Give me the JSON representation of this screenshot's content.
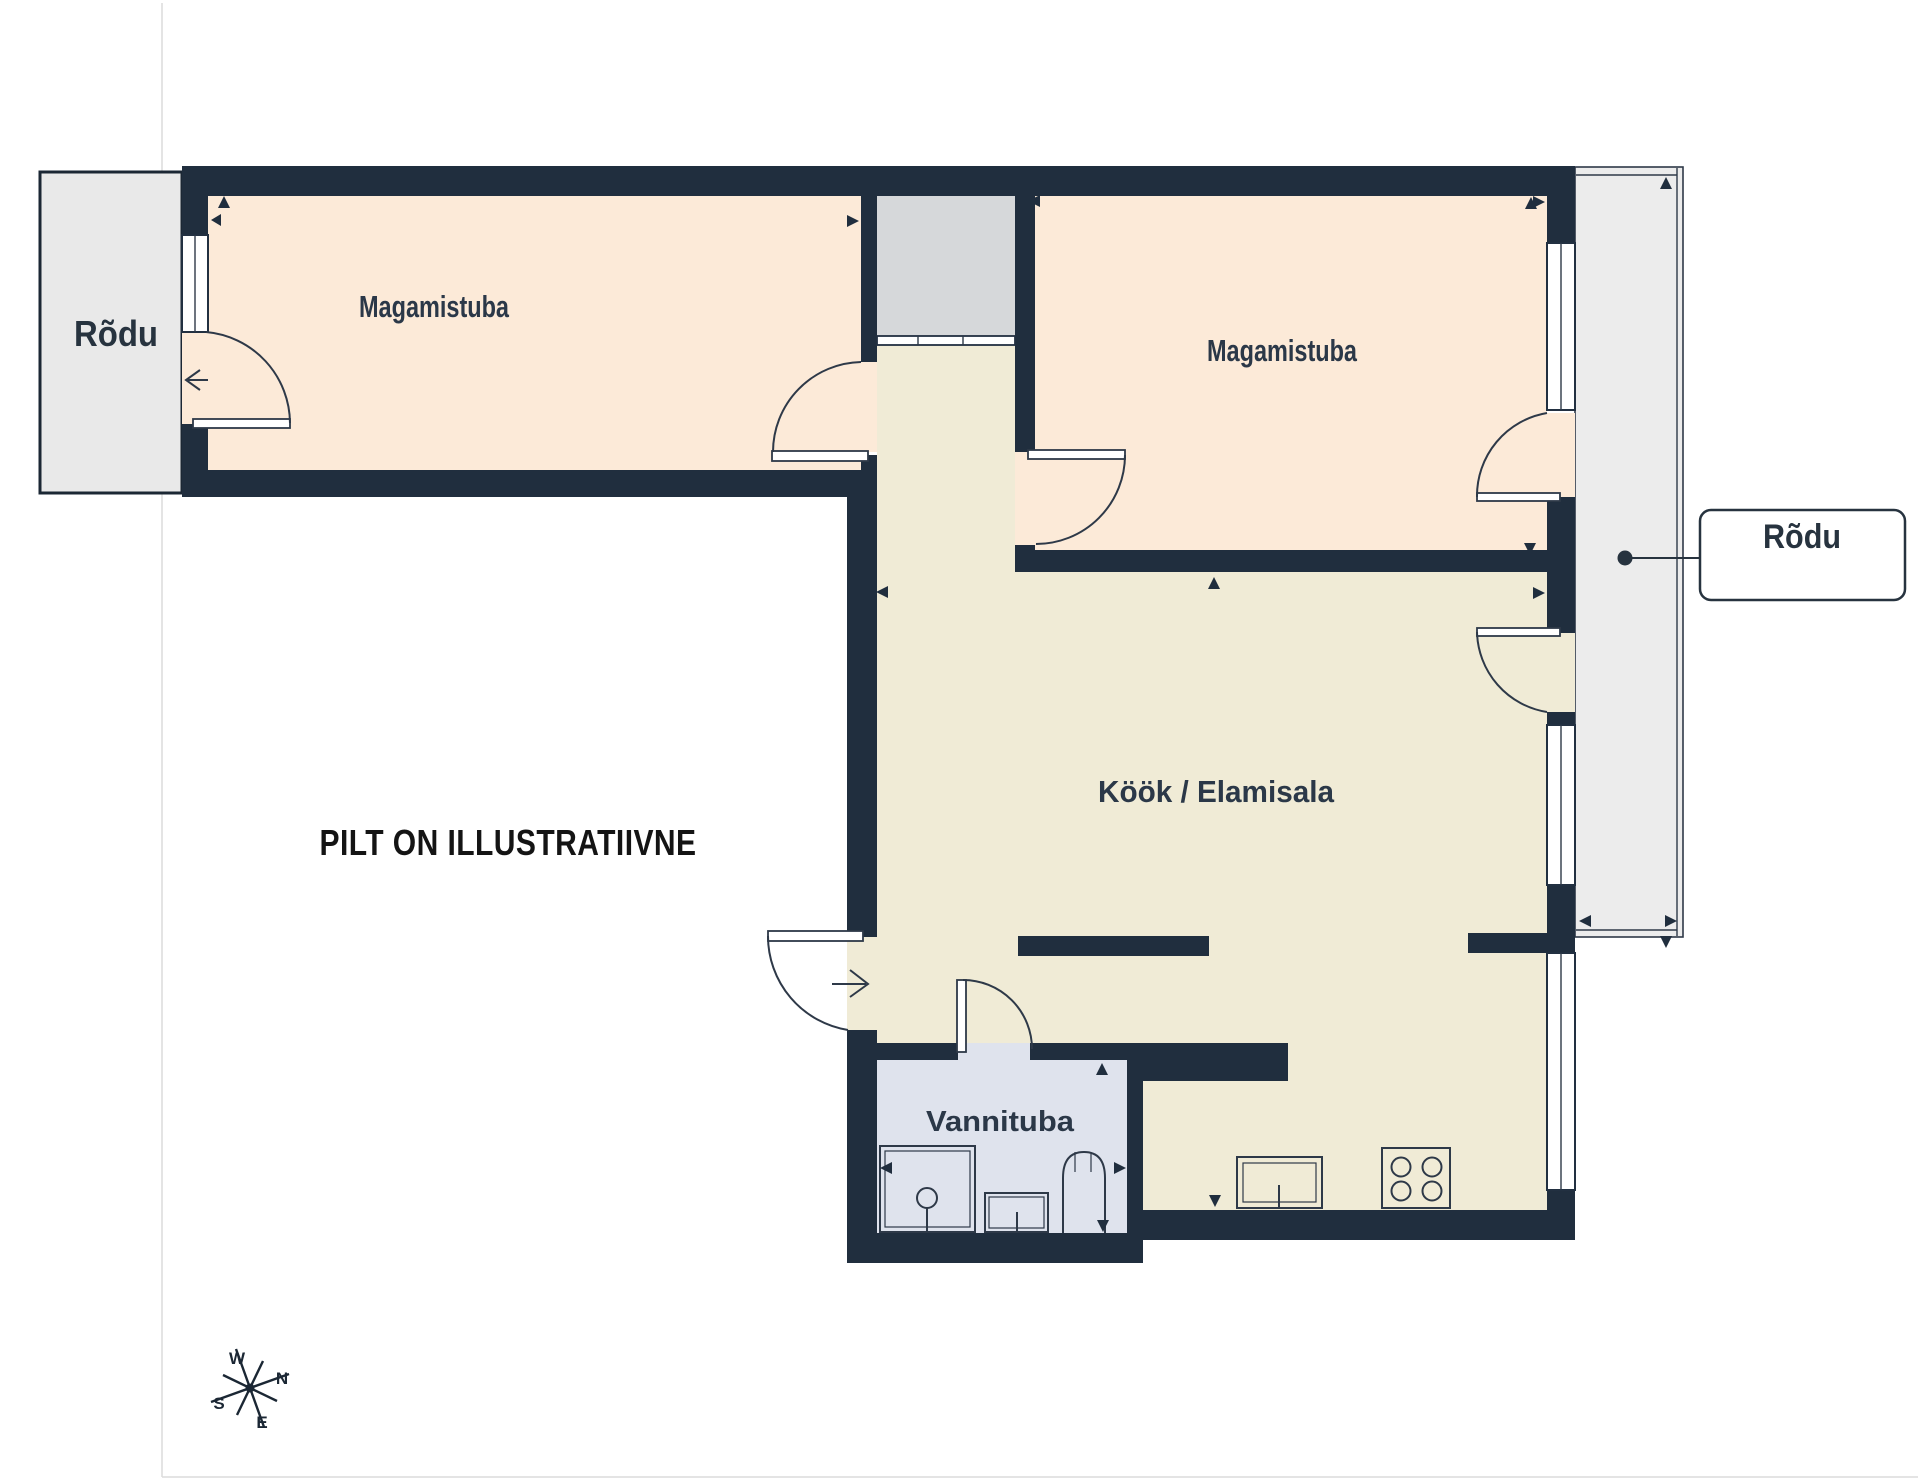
{
  "labels": {
    "bedroom1": "Magamistuba",
    "bedroom2": "Magamistuba",
    "kitchen_living": "Köök / Elamisala",
    "bathroom": "Vannituba",
    "balcony_left": "Rõdu",
    "balcony_right": "Rõdu",
    "disclaimer": "PILT ON ILLUSTRATIIVNE"
  },
  "compass": {
    "west": "W",
    "north": "N",
    "south": "S",
    "east": "E"
  },
  "colors": {
    "wall": "#202e3e",
    "line": "#2e3948",
    "bedroom_fill": "#fcead8",
    "kitchen_fill": "#f0ebd6",
    "bathroom_fill": "#dfe3ed",
    "shaft_fill": "#d6d8da",
    "balcony_left_fill": "#e9e9e9",
    "balcony_right_fill": "#ececec",
    "label_text": "#2b3848",
    "disclaimer_text": "#141414",
    "page_border": "#dcdcdc"
  }
}
